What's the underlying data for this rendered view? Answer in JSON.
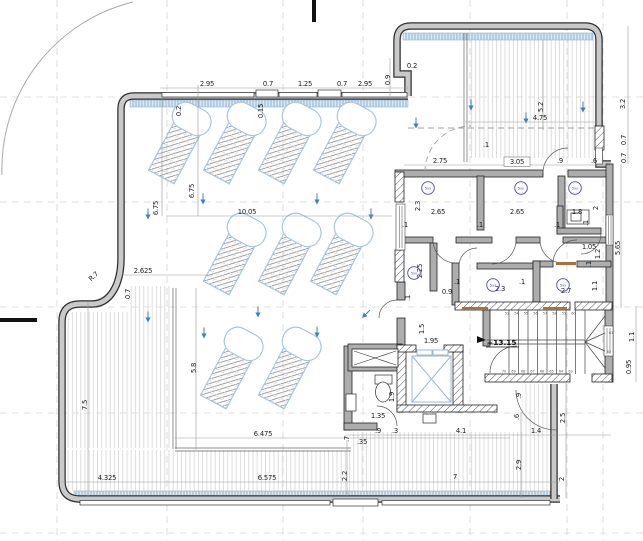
{
  "plan": {
    "type": "architectural-floor-plan",
    "description": "Roof terrace level plan with lounge chairs, decking, rooms, elevator and winder stair"
  },
  "colors": {
    "wall_fill": "#c9c9c9",
    "wall_edge": "#2e2e2e",
    "chair_outline": "#a8c6e2",
    "glass_band": "#d9e8f4",
    "glass_band_hatch": "#7fa6c8",
    "room_tag": "#4a4ab0",
    "slope_arrow": "#3f7fc4",
    "deck_line": "#d9d9d9",
    "dimension_text": "#1b1b1b",
    "door_leaf": "#a9713c"
  },
  "level_marker": {
    "t": "+13.15",
    "x": 487,
    "y": 345
  },
  "labels": [
    {
      "t": "2.95",
      "x": 207,
      "y": 86
    },
    {
      "t": "0.7",
      "x": 268,
      "y": 86
    },
    {
      "t": "1.25",
      "x": 305,
      "y": 86
    },
    {
      "t": "0.7",
      "x": 342,
      "y": 86
    },
    {
      "t": "2.95",
      "x": 365,
      "y": 86
    },
    {
      "t": "0.9",
      "x": 390,
      "y": 80,
      "r": -90
    },
    {
      "t": "0.2",
      "x": 412,
      "y": 68
    },
    {
      "t": "0.2",
      "x": 181,
      "y": 111,
      "r": -90
    },
    {
      "t": "0.15",
      "x": 263,
      "y": 111,
      "r": -90
    },
    {
      "t": "5.2",
      "x": 543,
      "y": 107,
      "r": -90
    },
    {
      "t": "4.75",
      "x": 540,
      "y": 120
    },
    {
      "t": "3.2",
      "x": 625,
      "y": 104,
      "r": -90
    },
    {
      "t": "0.7",
      "x": 626,
      "y": 140,
      "r": -90
    },
    {
      "t": "0.7",
      "x": 626,
      "y": 158,
      "r": -90
    },
    {
      "t": ".1",
      "x": 486,
      "y": 147
    },
    {
      "t": "2.75",
      "x": 440,
      "y": 163
    },
    {
      "t": "3.05",
      "x": 517,
      "y": 164
    },
    {
      "t": ".9",
      "x": 560,
      "y": 163
    },
    {
      "t": ".6",
      "x": 594,
      "y": 163
    },
    {
      "t": "2.3",
      "x": 420,
      "y": 206,
      "r": -90
    },
    {
      "t": "2.65",
      "x": 438,
      "y": 214
    },
    {
      "t": "2.65",
      "x": 517,
      "y": 214
    },
    {
      "t": "1.8",
      "x": 577,
      "y": 214
    },
    {
      "t": "2",
      "x": 598,
      "y": 208,
      "r": -90
    },
    {
      "t": ".1",
      "x": 405,
      "y": 227
    },
    {
      "t": ".1",
      "x": 480,
      "y": 227
    },
    {
      "t": ".1",
      "x": 557,
      "y": 227
    },
    {
      "t": ".1",
      "x": 588,
      "y": 223,
      "r": -90
    },
    {
      "t": "1.05",
      "x": 589,
      "y": 249
    },
    {
      "t": "1.2",
      "x": 600,
      "y": 254,
      "r": -90
    },
    {
      "t": "5.65",
      "x": 620,
      "y": 248,
      "r": -90
    },
    {
      "t": ".1",
      "x": 591,
      "y": 264,
      "r": -90
    },
    {
      "t": "2.25",
      "x": 422,
      "y": 271,
      "r": -90
    },
    {
      "t": "0.9",
      "x": 447,
      "y": 294
    },
    {
      "t": ".1",
      "x": 410,
      "y": 298,
      "r": -90
    },
    {
      "t": ".1",
      "x": 457,
      "y": 284
    },
    {
      "t": "2.3",
      "x": 500,
      "y": 291
    },
    {
      "t": ".1",
      "x": 522,
      "y": 284
    },
    {
      "t": "2.7",
      "x": 566,
      "y": 293
    },
    {
      "t": "1.1",
      "x": 597,
      "y": 286,
      "r": -90
    },
    {
      "t": "1.1",
      "x": 634,
      "y": 337,
      "r": -90
    },
    {
      "t": "0.95",
      "x": 631,
      "y": 367,
      "r": -90
    },
    {
      "t": "1.5",
      "x": 424,
      "y": 329,
      "r": -90
    },
    {
      "t": "1.95",
      "x": 431,
      "y": 343
    },
    {
      "t": "1.9",
      "x": 394,
      "y": 397,
      "r": -90
    },
    {
      "t": "1.35",
      "x": 378,
      "y": 418
    },
    {
      "t": ".9",
      "x": 521,
      "y": 396,
      "r": -90
    },
    {
      "t": ".6",
      "x": 519,
      "y": 417,
      "r": -90
    },
    {
      "t": ".7",
      "x": 349,
      "y": 439,
      "r": -90
    },
    {
      "t": ".35",
      "x": 362,
      "y": 444
    },
    {
      "t": ".9",
      "x": 378,
      "y": 433
    },
    {
      "t": ".3",
      "x": 395,
      "y": 433
    },
    {
      "t": "4.1",
      "x": 461,
      "y": 433
    },
    {
      "t": "1.4",
      "x": 536,
      "y": 433
    },
    {
      "t": "2.5",
      "x": 565,
      "y": 418,
      "r": -90
    },
    {
      "t": "2",
      "x": 564,
      "y": 479,
      "r": -90
    },
    {
      "t": "2.9",
      "x": 521,
      "y": 465,
      "r": -90
    },
    {
      "t": "2.2",
      "x": 347,
      "y": 476,
      "r": -90
    },
    {
      "t": "7",
      "x": 455,
      "y": 479
    },
    {
      "t": "4.325",
      "x": 107,
      "y": 480
    },
    {
      "t": "6.575",
      "x": 267,
      "y": 480
    },
    {
      "t": "6.475",
      "x": 263,
      "y": 436
    },
    {
      "t": "5.8",
      "x": 196,
      "y": 368,
      "r": -90
    },
    {
      "t": "7.5",
      "x": 87,
      "y": 405,
      "r": -90
    },
    {
      "t": "2.625",
      "x": 143,
      "y": 273
    },
    {
      "t": "0.7",
      "x": 130,
      "y": 294,
      "r": -90
    },
    {
      "t": "R.7",
      "x": 95,
      "y": 278,
      "r": -42
    },
    {
      "t": "6.75",
      "x": 158,
      "y": 208,
      "r": -90
    },
    {
      "t": "6.75",
      "x": 194,
      "y": 191,
      "r": -90
    },
    {
      "t": "10.05",
      "x": 247,
      "y": 214
    }
  ],
  "room_tags": [
    {
      "t": "5xx",
      "x": 428,
      "y": 188
    },
    {
      "t": "5xx",
      "x": 521,
      "y": 188
    },
    {
      "t": "5xx",
      "x": 575,
      "y": 188
    },
    {
      "t": "5xx",
      "x": 414,
      "y": 273
    },
    {
      "t": "5xx",
      "x": 493,
      "y": 285
    },
    {
      "t": "5xx",
      "x": 563,
      "y": 285
    }
  ],
  "stairs": {
    "top_run": {
      "nums": [
        "53",
        "54",
        "55",
        "56",
        "57",
        "58",
        "59",
        "60"
      ],
      "x": 507,
      "y": 314.5,
      "dx": 9.5
    },
    "bottom_run": {
      "nums": [
        "70",
        "69",
        "68",
        "67",
        "66",
        "65",
        "64",
        "63"
      ],
      "x": 504,
      "y": 372.5,
      "dx": 9.5
    },
    "winders": [
      {
        "t": "61",
        "x": 611,
        "y": 334
      },
      {
        "t": "62",
        "x": 609,
        "y": 353
      }
    ]
  }
}
